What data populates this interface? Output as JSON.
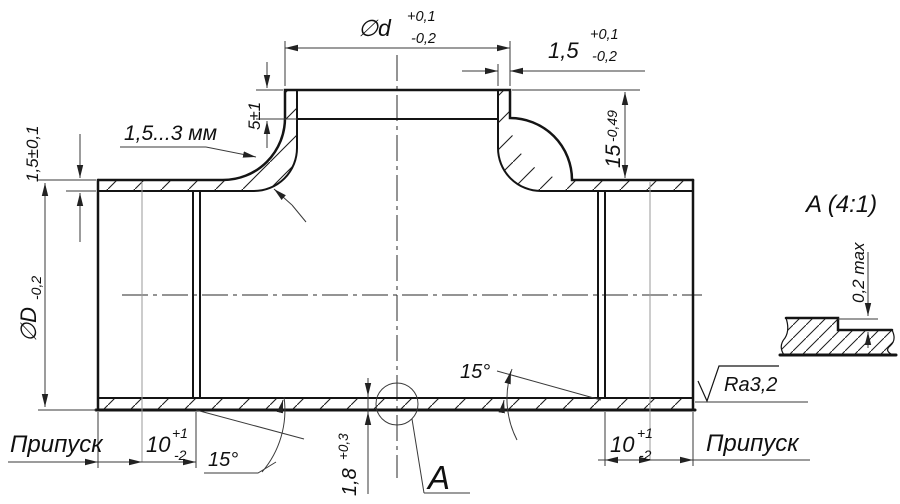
{
  "meta": {
    "drawing_type": "tee-pipe-section",
    "background_color": "#ffffff",
    "line_color": "#141414",
    "dimension_line_color": "#3a3a3a"
  },
  "dims": {
    "branch_dia": {
      "prefix": "∅d",
      "plus": "+0,1",
      "minus": "-0,2"
    },
    "branch_end_wall": {
      "value": "1,5",
      "plus": "+0,1",
      "minus": "-0,2"
    },
    "recess_depth": {
      "value": "5±1"
    },
    "fillet_thickness_note": {
      "value": "1,5...3 мм"
    },
    "branch_height": {
      "value": "15",
      "minus": "-0,49"
    },
    "main_wall": {
      "value": "1,5±0,1"
    },
    "main_dia": {
      "prefix": "∅D",
      "minus": "-0,2"
    },
    "left_allowance": {
      "label": "Припуск"
    },
    "left_end_length": {
      "value": "10",
      "plus": "+1",
      "minus": "-2"
    },
    "left_taper_angle": {
      "value": "15°"
    },
    "bottom_wall": {
      "value": "1,8",
      "plus": "+0,3"
    },
    "right_taper_angle": {
      "value": "15°"
    },
    "right_end_length": {
      "value": "10",
      "plus": "+1",
      "minus": "-2"
    },
    "right_allowance": {
      "label": "Припуск"
    },
    "surface_roughness": {
      "value": "Ra3,2"
    },
    "detail_marker": {
      "value": "A"
    },
    "detail_view_title": {
      "value": "A (4:1)"
    },
    "detail_step_height": {
      "value": "0,2 max"
    }
  }
}
